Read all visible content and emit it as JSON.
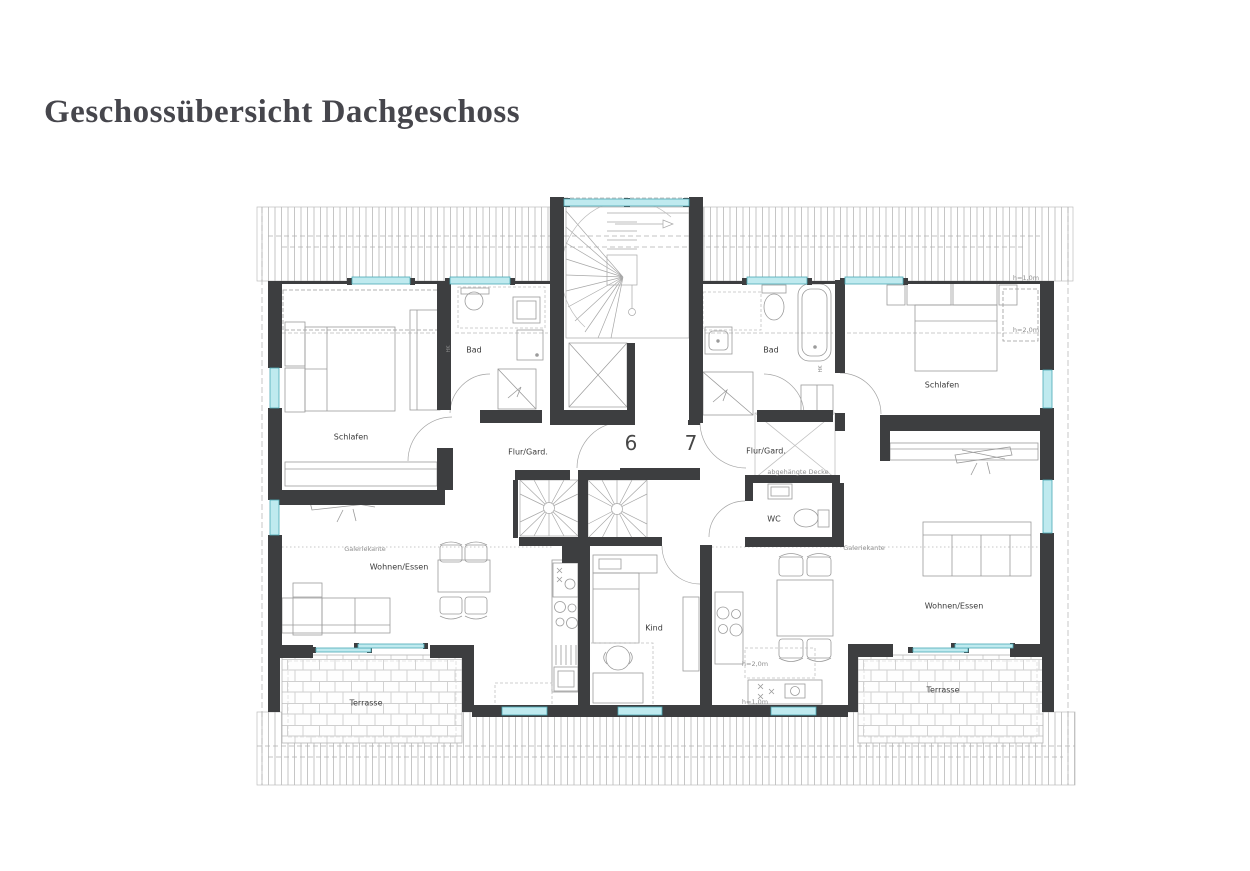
{
  "title": "Geschossübersicht Dachgeschoss",
  "apartments": {
    "six": {
      "number": "6",
      "schlafen": "Schlafen",
      "bad": "Bad",
      "flur": "Flur/Gard.",
      "wohnen": "Wohnen/Essen",
      "terrasse": "Terrasse",
      "galerie": "Galeriekante",
      "hk": "HK"
    },
    "seven": {
      "number": "7",
      "schlafen": "Schlafen",
      "bad": "Bad",
      "flur": "Flur/Gard.",
      "wc": "WC",
      "kind": "Kind",
      "wohnen": "Wohnen/Essen",
      "terrasse": "Terrasse",
      "galerie": "Galeriekante",
      "decke": "abgehängte Decke",
      "hk": "HK",
      "h_roof_upper": "h=1,0m",
      "h_roof_lower": "h=2,0m",
      "h_kitchen": "h=2,0m",
      "h_window": "h=1,0m"
    }
  },
  "colors": {
    "wall": "#3d3e40",
    "window_fill": "#bfeaef",
    "window_frame": "#49a8b5",
    "window_cap": "#151515",
    "furniture_line": "#9b9b9b",
    "hatch_line": "#c6c6c6",
    "brick_line": "#cfcfcf",
    "dash_line": "#b0b0b0",
    "label_text": "#3a3a3a",
    "annotation_text": "#8f8f8f",
    "title_text": "#46464c"
  }
}
